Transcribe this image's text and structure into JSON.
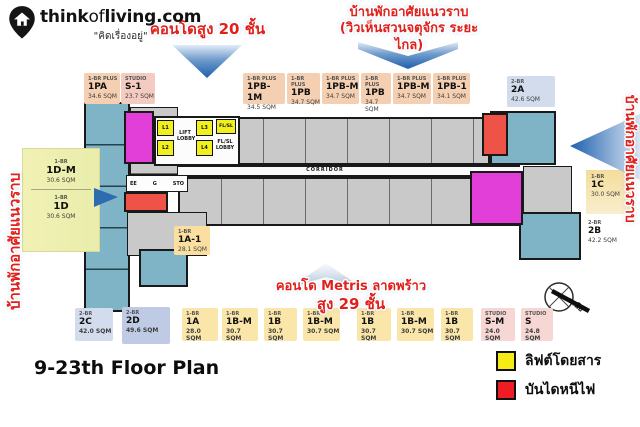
{
  "logo": {
    "brand_bold1": "think",
    "brand_light": "of",
    "brand_bold2": "living",
    "brand_suffix": ".com",
    "tagline": "\"คิดเรื่องอยู่\""
  },
  "callouts": {
    "condo_20": "คอนโดสูง 20 ชั้น",
    "housing_top_line1": "บ้านพักอาศัยแนวราบ",
    "housing_top_line2": "(วิวเห็นสวนจตุจักร ระยะไกล)",
    "housing_left": "บ้านพักอาศัยแนวราบ",
    "housing_right": "บ้านพักอาศัยแนวราบ",
    "metris_line1": "คอนโด Metris ลาดพร้าว",
    "metris_line2": "สูง 29 ชั้น"
  },
  "floor_plan": {
    "title": "9-23th Floor Plan",
    "corridor": "CORRIDOR",
    "lift_lobby": "LIFT LOBBY",
    "flsl": "FL/SL",
    "flsl_lobby": "FL/SL LOBBY",
    "lifts": [
      "L1",
      "L2",
      "L3",
      "L4"
    ],
    "service_rooms": [
      "EE",
      "G",
      "STO"
    ],
    "inner_unit": {
      "type": "1-BR",
      "code": "1A-1",
      "area": "28.1 SQM"
    }
  },
  "units_top": [
    {
      "type": "1-BR PLUS",
      "code": "1PA",
      "area": "34.6 SQM"
    },
    {
      "type": "STUDIO",
      "code": "S-1",
      "area": "23.7 SQM"
    },
    {
      "type": "1-BR PLUS",
      "code": "1PB-1M",
      "area": "34.5 SQM"
    },
    {
      "type": "1-BR PLUS",
      "code": "1PB",
      "area": "34.7 SQM"
    },
    {
      "type": "1-BR PLUS",
      "code": "1PB-M",
      "area": "34.7 SQM"
    },
    {
      "type": "1-BR PLUS",
      "code": "1PB",
      "area": "34.7 SQM"
    },
    {
      "type": "1-BR PLUS",
      "code": "1PB-M",
      "area": "34.7 SQM"
    },
    {
      "type": "1-BR PLUS",
      "code": "1PB-1",
      "area": "34.1 SQM"
    },
    {
      "type": "2-BR",
      "code": "2A",
      "area": "42.6 SQM"
    }
  ],
  "units_left": [
    {
      "type": "1-BR",
      "code": "1D-M",
      "area": "30.6 SQM"
    },
    {
      "type": "1-BR",
      "code": "1D",
      "area": "30.6 SQM"
    }
  ],
  "units_right": [
    {
      "type": "1-BR",
      "code": "1C",
      "area": "30.0 SQM"
    },
    {
      "type": "2-BR",
      "code": "2B",
      "area": "42.2 SQM"
    }
  ],
  "units_bottom": [
    {
      "type": "2-BR",
      "code": "2C",
      "area": "42.0 SQM"
    },
    {
      "type": "2-BR",
      "code": "2D",
      "area": "49.6 SQM"
    },
    {
      "type": "1-BR",
      "code": "1A",
      "area": "28.0 SQM"
    },
    {
      "type": "1-BR",
      "code": "1B-M",
      "area": "30.7 SQM"
    },
    {
      "type": "1-BR",
      "code": "1B",
      "area": "30.7 SQM"
    },
    {
      "type": "1-BR",
      "code": "1B-M",
      "area": "30.7 SQM"
    },
    {
      "type": "1-BR",
      "code": "1B",
      "area": "30.7 SQM"
    },
    {
      "type": "1-BR",
      "code": "1B-M",
      "area": "30.7 SQM"
    },
    {
      "type": "1-BR",
      "code": "1B",
      "area": "30.7 SQM"
    },
    {
      "type": "STUDIO",
      "code": "S-M",
      "area": "24.0 SQM"
    },
    {
      "type": "STUDIO",
      "code": "S",
      "area": "24.8 SQM"
    }
  ],
  "legend": [
    {
      "label": "ลิฟต์โดยสาร",
      "color": "#f6ec13"
    },
    {
      "label": "บันไดหนีไฟ",
      "color": "#ee1c25"
    }
  ],
  "compass": {
    "north_label": "เหนือ"
  },
  "colors": {
    "banner_text": "#e0201b",
    "arrow_blue": "#2e6cb0",
    "unit_teal": "#7fb3c6",
    "unit_gray": "#c9c9c9",
    "unit_highlight": "#e23fd8",
    "lift_yellow": "#f2ef1f",
    "fire_stair_red": "#ef5348"
  }
}
